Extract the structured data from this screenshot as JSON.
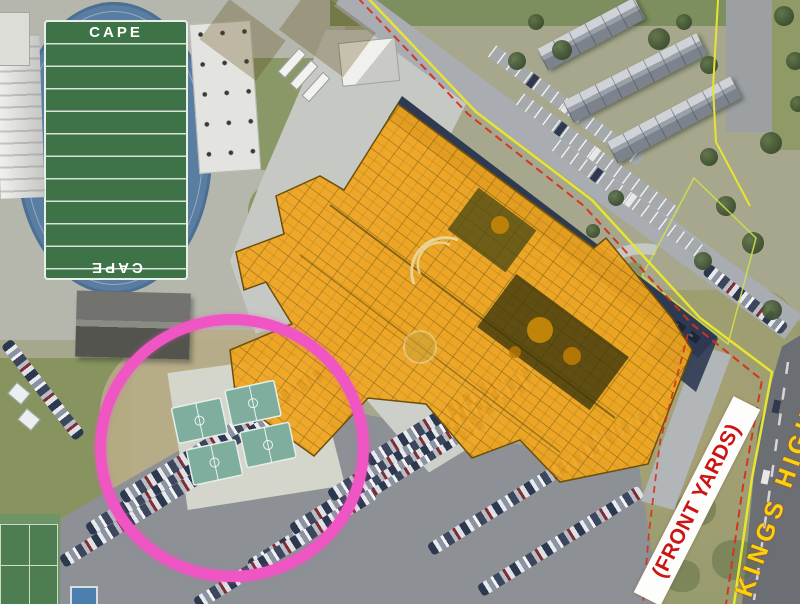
{
  "map": {
    "stadium": {
      "endzone_top": "CAPE",
      "endzone_bottom": "CAPE"
    },
    "annotations": {
      "front_yards_label": "(FRONT YARDS)",
      "highway_label": "KINGS HIGHWAY"
    },
    "colors": {
      "building_overlay_orange": "#F1A51D",
      "annotation_circle_pink": "#F055C4",
      "property_line_yellow": "#E6E530",
      "setback_line_red": "#D5301D",
      "basketball_court_teal": "#7FAE9E",
      "track_blue": "#5A7DA2",
      "field_green": "#3D7347",
      "front_yards_text_red": "#CC1414",
      "highway_text_yellow": "#F3D50E"
    }
  }
}
